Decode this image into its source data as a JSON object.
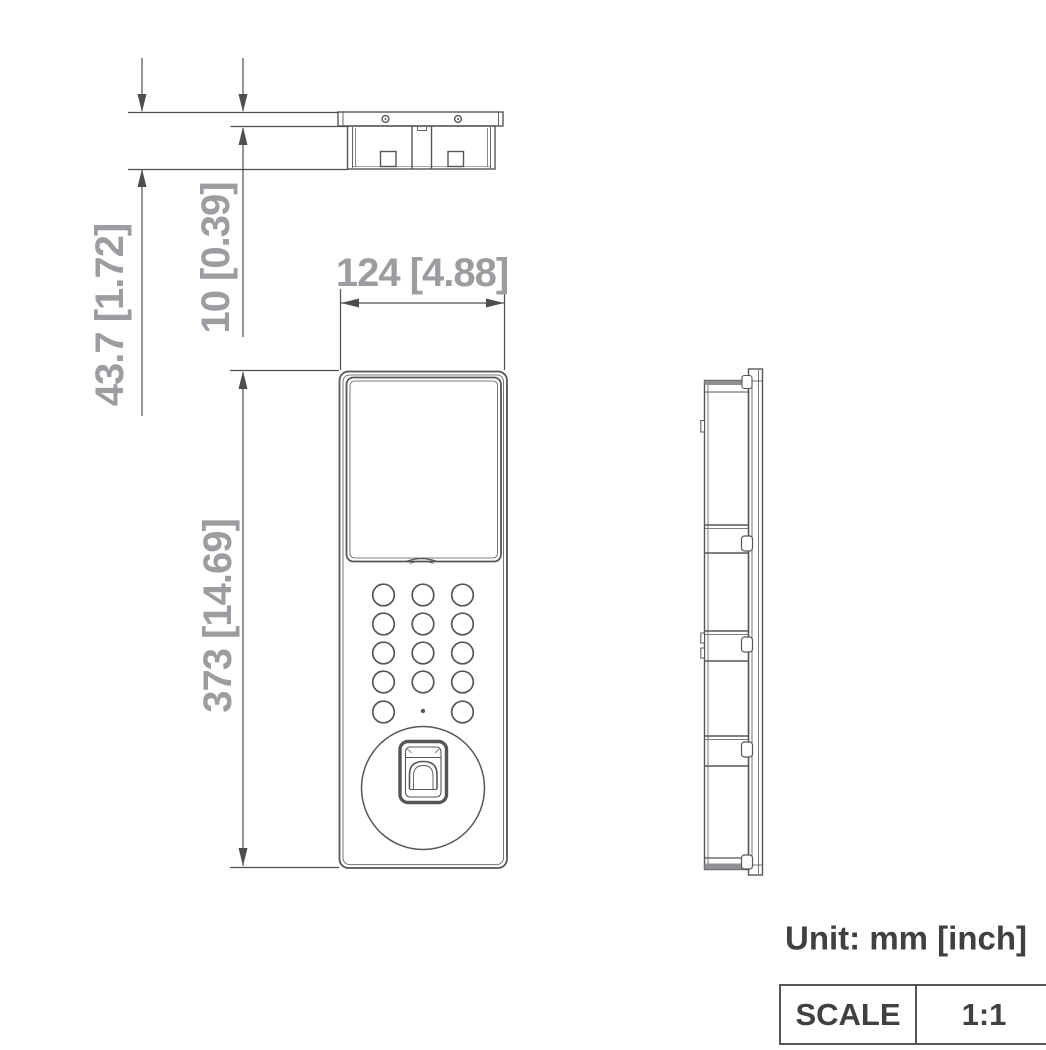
{
  "drawing": {
    "dimensions": {
      "total_depth": "43.7 [1.72]",
      "panel_thickness": "10 [0.39]",
      "width": "124 [4.88]",
      "height": "373 [14.69]"
    },
    "unit_note": "Unit: mm [inch]",
    "scale": {
      "label": "SCALE",
      "value": "1:1"
    },
    "colors": {
      "outline": "#55565A",
      "dimension_line": "#4D4E50",
      "dimension_text": "#9B9DA0",
      "annotation_text": "#3F4042"
    }
  }
}
